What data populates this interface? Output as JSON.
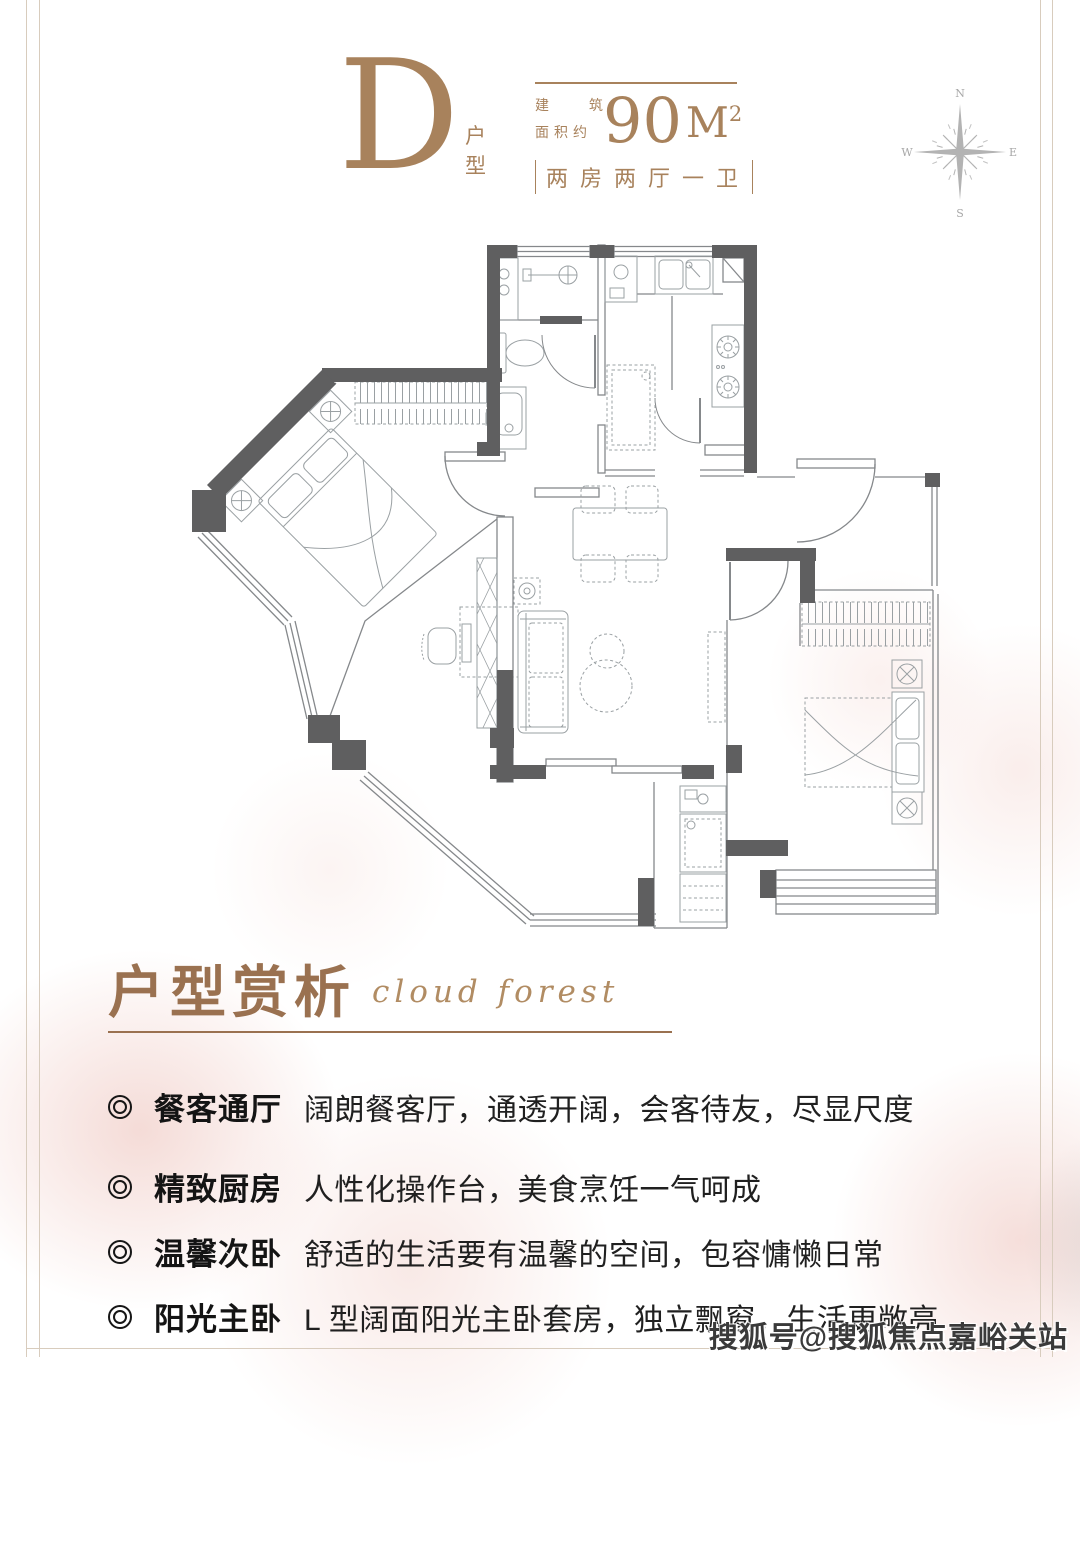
{
  "colors": {
    "accent_brown": "#a8825c",
    "title_brown": "#9a7150",
    "script_brown": "#b18c63",
    "wall_gray": "#5f5f60",
    "line_gray": "#85888b",
    "frame_line": "#d8ccbd",
    "text_dark": "#141414",
    "watermark_gray": "#3a3a3a"
  },
  "header": {
    "unit_letter": "D",
    "unit_type": "户型",
    "area_label_line1": "建 筑",
    "area_label_line2": "面积约",
    "area_value": "90",
    "area_unit": "M",
    "area_sup": "2",
    "rooms_desc": "两房两厅一卫"
  },
  "compass": {
    "n": "N",
    "e": "E",
    "s": "S",
    "w": "W"
  },
  "section": {
    "title": "户型赏析",
    "subtitle": "cloud forest"
  },
  "features": [
    {
      "label": "餐客通厅",
      "desc": "阔朗餐客厅，通透开阔，会客待友，尽显尺度"
    },
    {
      "label": "精致厨房",
      "desc": "人性化操作台，美食烹饪一气呵成"
    },
    {
      "label": "温馨次卧",
      "desc": "舒适的生活要有温馨的空间，包容慵懒日常"
    },
    {
      "label": "阳光主卧",
      "desc": "L 型阔面阳光主卧套房，独立飘窗，生活更敞亮"
    }
  ],
  "watermark": "搜狐号@搜狐焦点嘉峪关站"
}
